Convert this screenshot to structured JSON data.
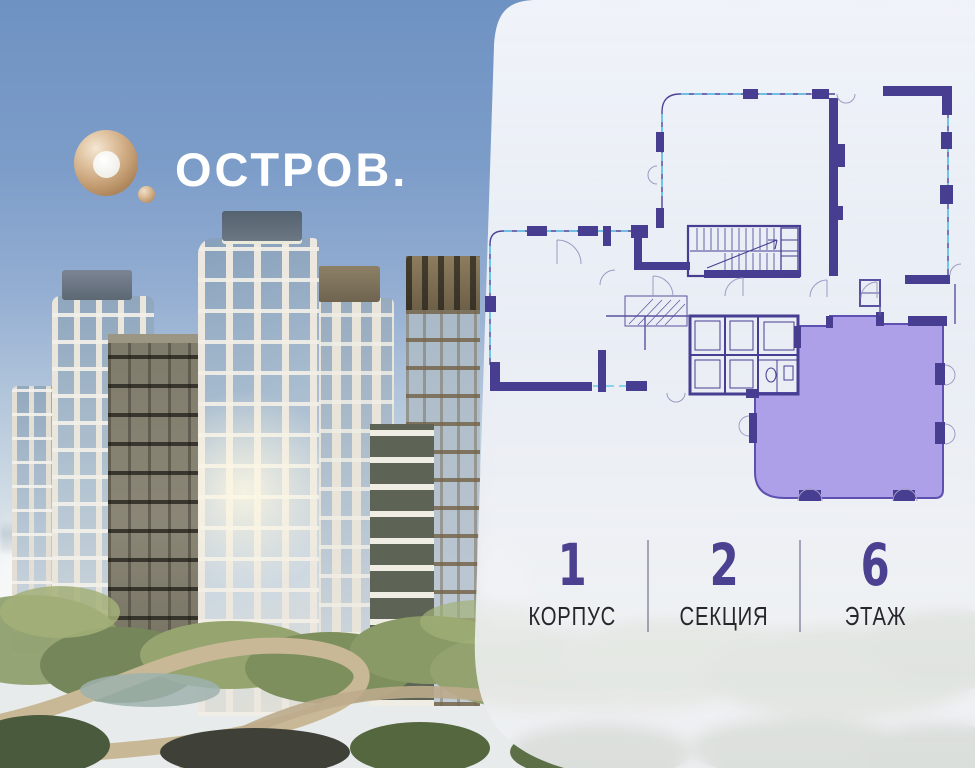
{
  "logo": {
    "text": "ОСТРОВ."
  },
  "panel": {
    "stats": [
      {
        "value": "1",
        "label": "КОРПУС"
      },
      {
        "value": "2",
        "label": "СЕКЦИЯ"
      },
      {
        "value": "6",
        "label": "ЭТАЖ"
      }
    ]
  },
  "colors": {
    "accent_number": "#4b4191",
    "wall": "#473e92",
    "highlight_fill": "#a89ae7",
    "highlight_stroke": "#5c50b0",
    "window_line": "#62cbe9",
    "logo_gold": "#c7a177",
    "panel_background": "rgba(241,243,248,0.9)"
  }
}
